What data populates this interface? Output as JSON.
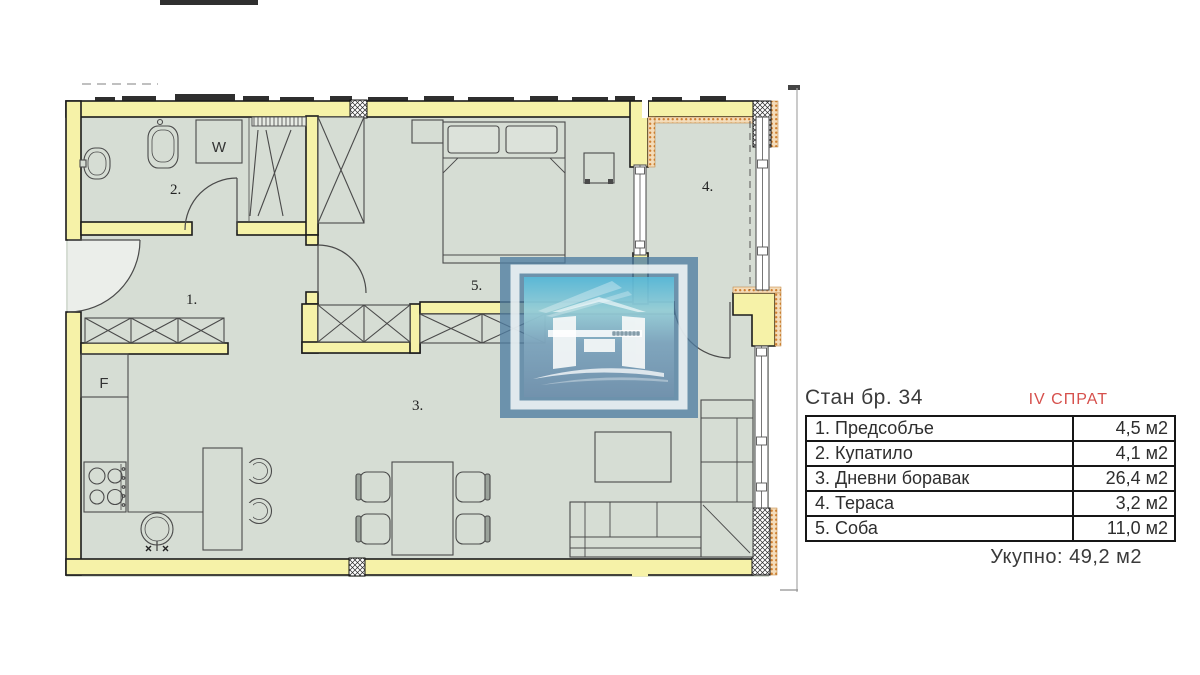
{
  "header": {
    "title": "Стан бр. 34",
    "floor": "IV СПРАТ"
  },
  "table": {
    "rows": [
      {
        "name": "1. Предсобље",
        "area": "4,5 м2"
      },
      {
        "name": "2. Купатило",
        "area": "4,1 м2"
      },
      {
        "name": "3. Дневни боравак",
        "area": "26,4 м2"
      },
      {
        "name": "4. Тераса",
        "area": "3,2 м2"
      },
      {
        "name": "5. Соба",
        "area": "11,0 м2"
      }
    ],
    "total": "Укупно: 49,2 м2"
  },
  "plan": {
    "room_labels": [
      {
        "id": "hallway",
        "label": "1."
      },
      {
        "id": "bathroom",
        "label": "2."
      },
      {
        "id": "living-room",
        "label": "3."
      },
      {
        "id": "terrace",
        "label": "4."
      },
      {
        "id": "bedroom",
        "label": "5."
      }
    ],
    "appliance_labels": [
      {
        "id": "washing-machine",
        "label": "W"
      },
      {
        "id": "fridge",
        "label": "F"
      }
    ],
    "colors": {
      "wall": "#f6f2a8",
      "floor": "#d6ddd4",
      "insulation_dot": "#d08030",
      "line": "#1c1c1c",
      "furniture_line": "#4a4a4a"
    }
  },
  "colors": {
    "accent_red": "#d6504c",
    "logo_blue": "#4e7ca0"
  }
}
